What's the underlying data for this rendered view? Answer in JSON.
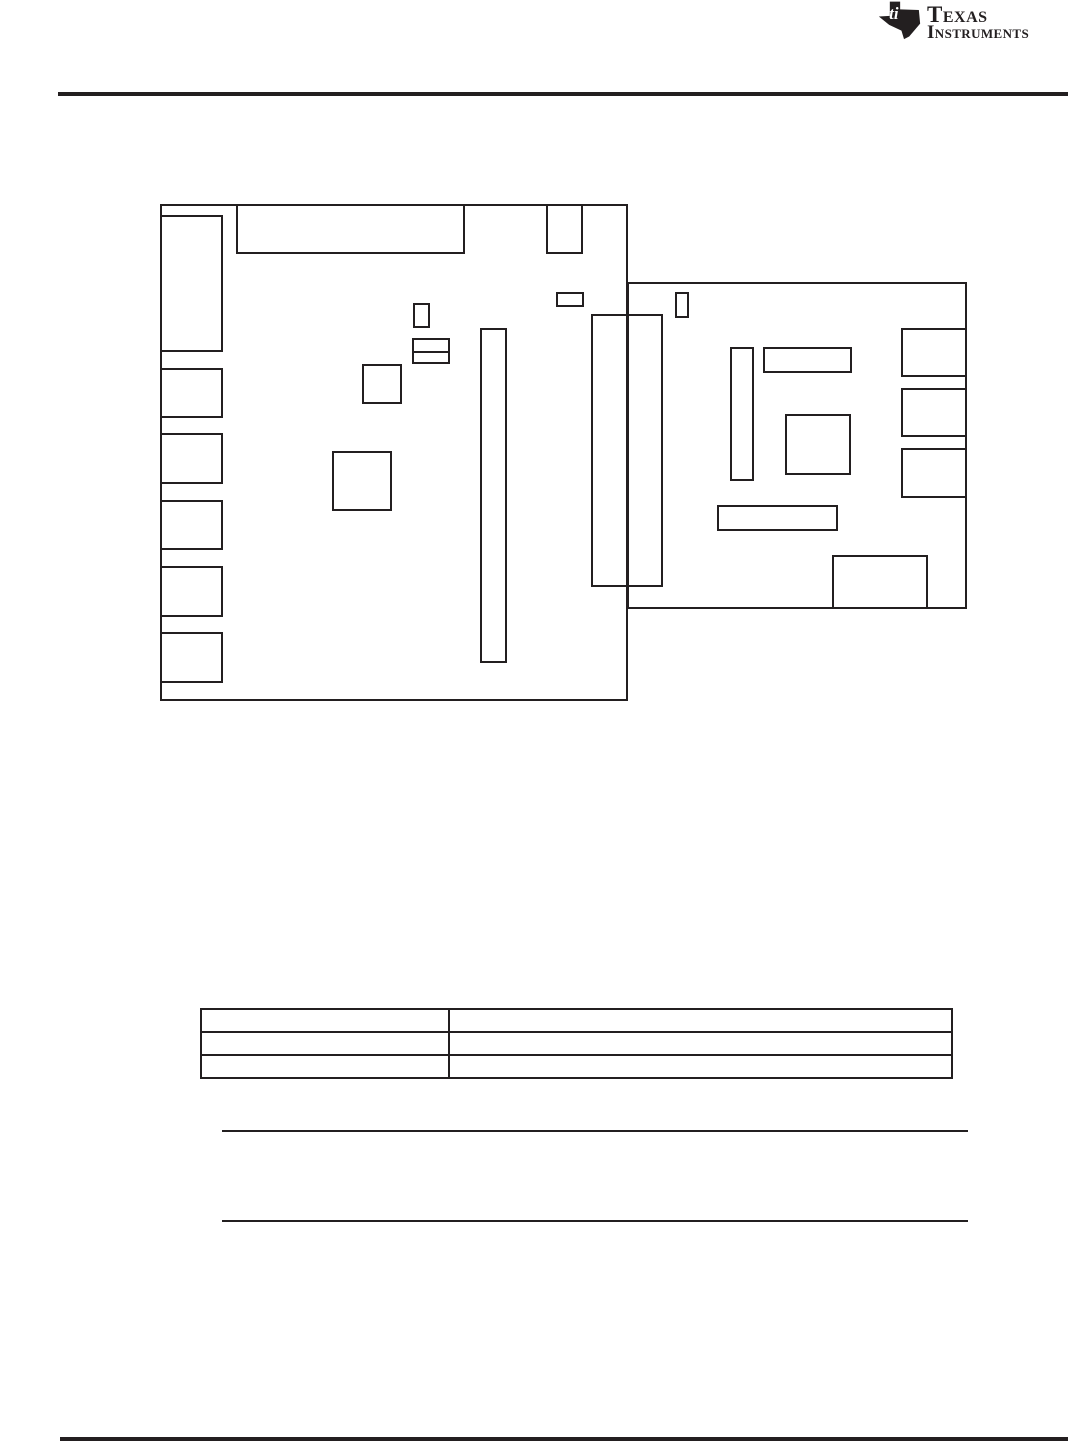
{
  "colors": {
    "ink": "#231f20",
    "page_bg": "#ffffff"
  },
  "header": {
    "logo": {
      "icon": "ti-texas-map-icon",
      "line1": "Texas",
      "line2": "Instruments"
    }
  },
  "figure": {
    "description": "two-board-outline-placement-diagram",
    "rects": [
      {
        "name": "board-1-outline",
        "x": 160,
        "y": 204,
        "w": 468,
        "h": 497
      },
      {
        "name": "board-1-top-connector",
        "x": 236,
        "y": 204,
        "w": 229,
        "h": 50
      },
      {
        "name": "board-1-top-right-component",
        "x": 546,
        "y": 204,
        "w": 37,
        "h": 50
      },
      {
        "name": "board-1-left-connector-tall",
        "x": 160,
        "y": 215,
        "w": 63,
        "h": 137
      },
      {
        "name": "board-1-left-connector-2",
        "x": 160,
        "y": 368,
        "w": 63,
        "h": 50
      },
      {
        "name": "board-1-left-connector-3",
        "x": 160,
        "y": 433,
        "w": 63,
        "h": 51
      },
      {
        "name": "board-1-left-connector-4",
        "x": 160,
        "y": 500,
        "w": 63,
        "h": 50
      },
      {
        "name": "board-1-left-connector-5",
        "x": 160,
        "y": 566,
        "w": 63,
        "h": 51
      },
      {
        "name": "board-1-left-connector-6",
        "x": 160,
        "y": 632,
        "w": 63,
        "h": 51
      },
      {
        "name": "board-1-small-flat-component",
        "x": 556,
        "y": 292,
        "w": 28,
        "h": 15
      },
      {
        "name": "board-1-small-vertical-component",
        "x": 413,
        "y": 303,
        "w": 17,
        "h": 25
      },
      {
        "name": "board-1-stacked-component-top",
        "x": 412,
        "y": 338,
        "w": 38,
        "h": 15
      },
      {
        "name": "board-1-stacked-component-bottom",
        "x": 412,
        "y": 351,
        "w": 38,
        "h": 13
      },
      {
        "name": "board-1-small-square-component",
        "x": 362,
        "y": 364,
        "w": 40,
        "h": 40
      },
      {
        "name": "board-1-large-square-component",
        "x": 332,
        "y": 451,
        "w": 60,
        "h": 60
      },
      {
        "name": "board-1-tall-slot",
        "x": 480,
        "y": 328,
        "w": 27,
        "h": 335
      },
      {
        "name": "board-2-outline",
        "x": 627,
        "y": 282,
        "w": 340,
        "h": 327
      },
      {
        "name": "board-2-small-vertical-component",
        "x": 675,
        "y": 292,
        "w": 14,
        "h": 26
      },
      {
        "name": "board-2-tall-component",
        "x": 730,
        "y": 347,
        "w": 24,
        "h": 134
      },
      {
        "name": "board-2-horizontal-component",
        "x": 763,
        "y": 347,
        "w": 89,
        "h": 26
      },
      {
        "name": "board-2-square-component",
        "x": 785,
        "y": 414,
        "w": 66,
        "h": 61
      },
      {
        "name": "board-2-right-connector-1",
        "x": 901,
        "y": 328,
        "w": 66,
        "h": 49
      },
      {
        "name": "board-2-right-connector-2",
        "x": 901,
        "y": 388,
        "w": 66,
        "h": 49
      },
      {
        "name": "board-2-right-connector-3",
        "x": 901,
        "y": 448,
        "w": 66,
        "h": 50
      },
      {
        "name": "board-2-wide-component",
        "x": 717,
        "y": 505,
        "w": 121,
        "h": 26
      },
      {
        "name": "board-2-bottom-component",
        "x": 832,
        "y": 555,
        "w": 96,
        "h": 54
      },
      {
        "name": "inter-board-connector",
        "x": 591,
        "y": 314,
        "w": 72,
        "h": 273
      }
    ]
  },
  "table": {
    "col_widths": [
      248,
      503
    ],
    "rows": [
      [
        "",
        ""
      ],
      [
        "",
        ""
      ],
      [
        "",
        ""
      ]
    ]
  }
}
